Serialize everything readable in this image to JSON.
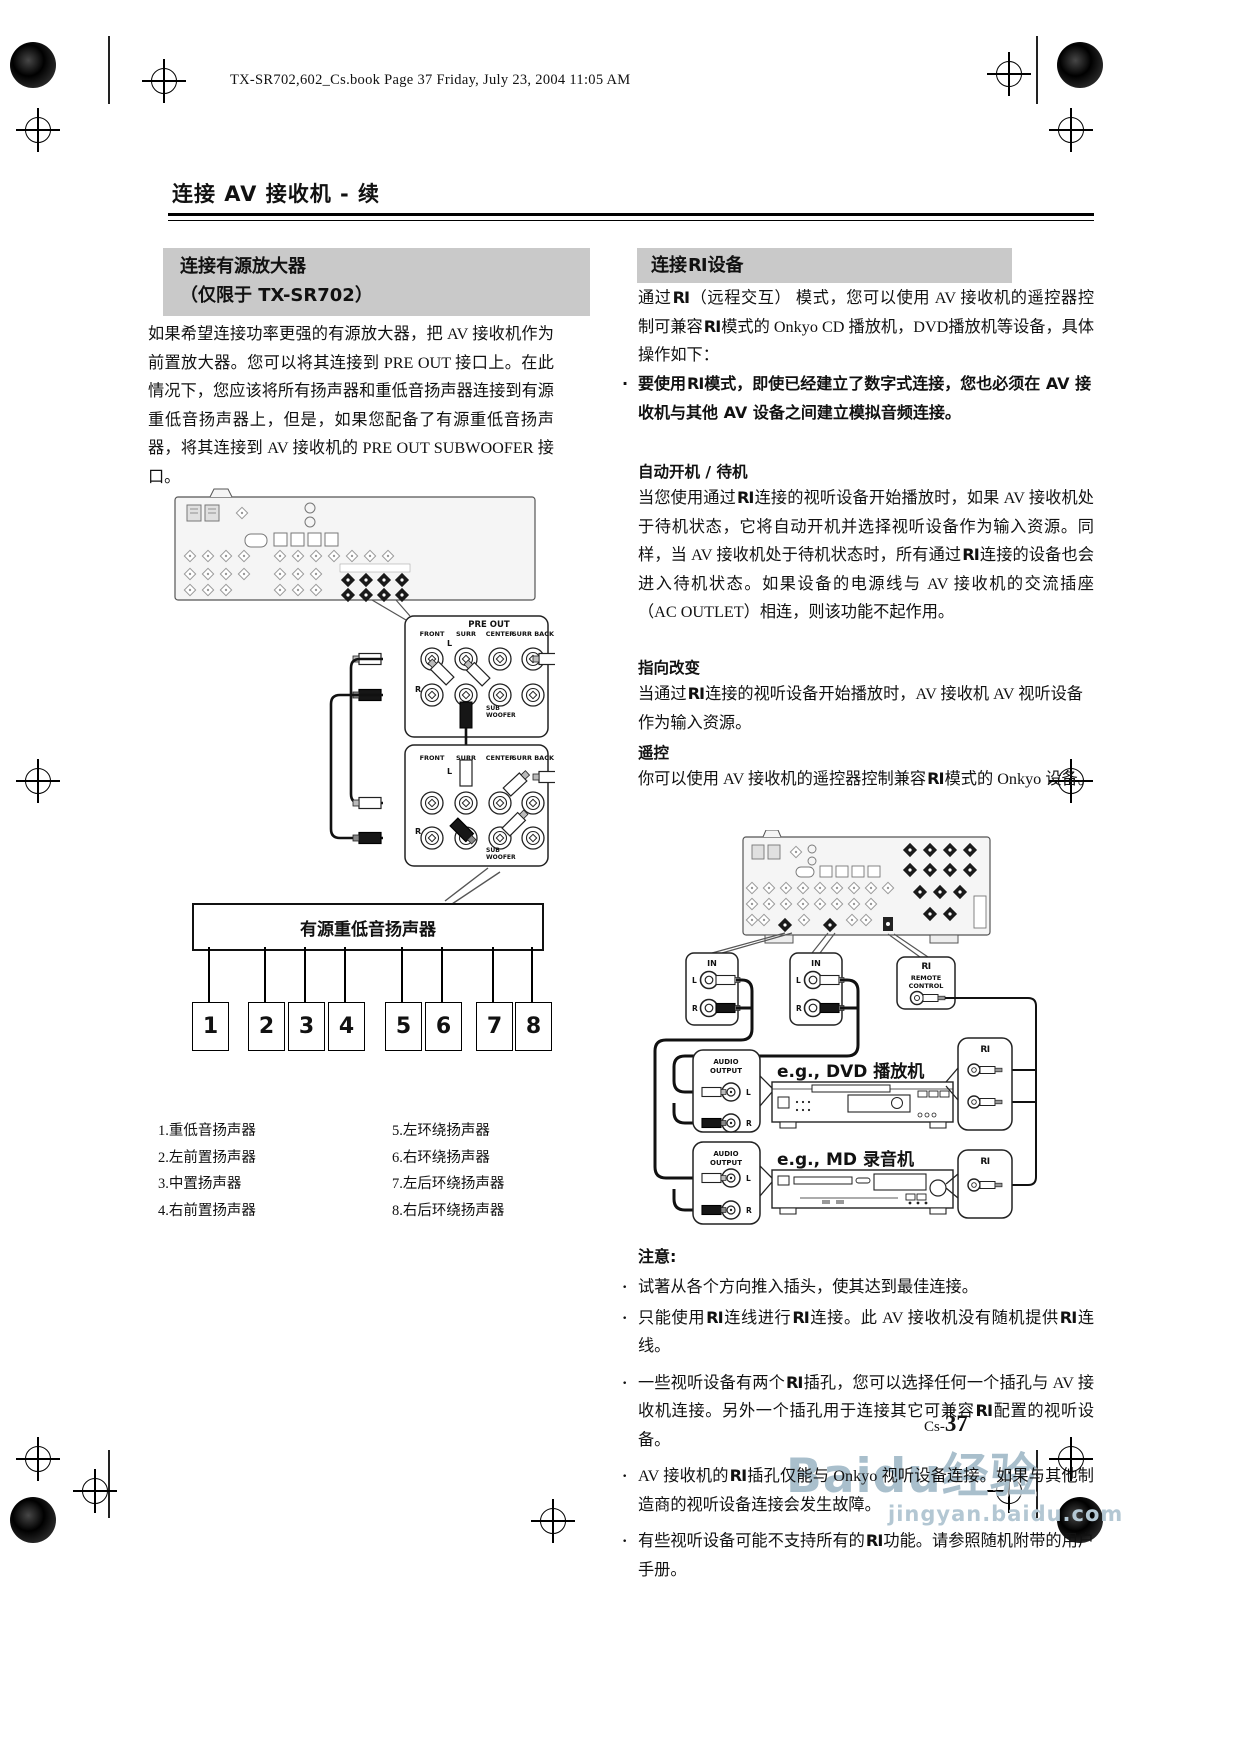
{
  "page": {
    "header": "TX-SR702,602_Cs.book  Page 37  Friday, July 23, 2004  11:05 AM",
    "title": "连接 AV 接收机 - 续",
    "footer": {
      "page_prefix": "Cs-",
      "page_number": "37"
    },
    "watermark": {
      "line1": "Baidu经验",
      "line2": "jingyan.baidu.com"
    }
  },
  "left": {
    "heading_line1": "连接有源放大器",
    "heading_line2": "（仅限于 TX-SR702）",
    "body": "如果希望连接功率更强的有源放大器，把 AV 接收机作为前置放大器。您可以将其连接到 PRE OUT 接口上。在此情况下，您应该将所有扬声器和重低音扬声器连接到有源重低音扬声器上，但是，如果您配备了有源重低音扬声器，将其连接到 AV 接收机的 PRE OUT SUBWOOFER 接口。",
    "preout": {
      "title": "PRE OUT",
      "channels": [
        "FRONT",
        "SURR",
        "CENTER",
        "SURR BACK"
      ],
      "left_label": "L",
      "right_label": "R",
      "sub_line1": "SUB",
      "sub_line2": "WOOFER"
    },
    "subwoofer_box": "有源重低音扬声器",
    "speaker_numbers": [
      "1",
      "2",
      "3",
      "4",
      "5",
      "6",
      "7",
      "8"
    ],
    "legend_col1": [
      "1.重低音扬声器",
      "2.左前置扬声器",
      "3.中置扬声器",
      "4.右前置扬声器"
    ],
    "legend_col2": [
      "5.左环绕扬声器",
      "6.右环绕扬声器",
      "7.左后环绕扬声器",
      "8.右后环绕扬声器"
    ]
  },
  "right": {
    "heading": "连接RI设备",
    "intro": "通过RI（远程交互） 模式，您可以使用 AV 接收机的遥控器控制可兼容RI模式的 Onkyo CD 播放机，DVD播放机等设备，具体操作如下：",
    "bullet_bold": "要使用RI模式，即使已经建立了数字式连接，您也必须在 AV 接收机与其他 AV 设备之间建立模拟音频连接。",
    "sections": [
      {
        "title": "自动开机 / 待机",
        "text": "当您使用通过RI连接的视听设备开始播放时，如果 AV 接收机处于待机状态，它将自动开机并选择视听设备作为输入资源。同样，当 AV 接收机处于待机状态时，所有通过RI连接的设备也会进入待机状态。如果设备的电源线与 AV 接收机的交流插座 （AC OUTLET）相连，则该功能不起作用。"
      },
      {
        "title": "指向改变",
        "text": "当通过RI连接的视听设备开始播放时，AV 接收机 AV 视听设备作为输入资源。"
      },
      {
        "title": "遥控",
        "text": "你可以使用 AV 接收机的遥控器控制兼容RI模式的 Onkyo 设备。"
      }
    ],
    "diagram": {
      "in_label": "IN",
      "l": "L",
      "r": "R",
      "ri_remote": {
        "ri": "RI",
        "line1": "REMOTE",
        "line2": "CONTROL"
      },
      "audio_line1": "AUDIO",
      "audio_line2": "OUTPUT",
      "dvd_label": "e.g., DVD 播放机",
      "md_label": "e.g., MD 录音机",
      "ri": "RI"
    },
    "notes_title": "注意:",
    "notes": [
      "试著从各个方向推入插头，使其达到最佳连接。",
      "只能使用RI连线进行RI连接。此 AV 接收机没有随机提供RI连线。",
      "一些视听设备有两个RI插孔，您可以选择任何一个插孔与 AV 接收机连接。另外一个插孔用于连接其它可兼容RI配置的视听设备。",
      "AV 接收机的RI插孔仅能与 Onkyo 视听设备连接。如果与其他制造商的视听设备连接会发生故障。",
      "有些视听设备可能不支持所有的RI功能。请参照随机附带的用户手册。"
    ]
  }
}
